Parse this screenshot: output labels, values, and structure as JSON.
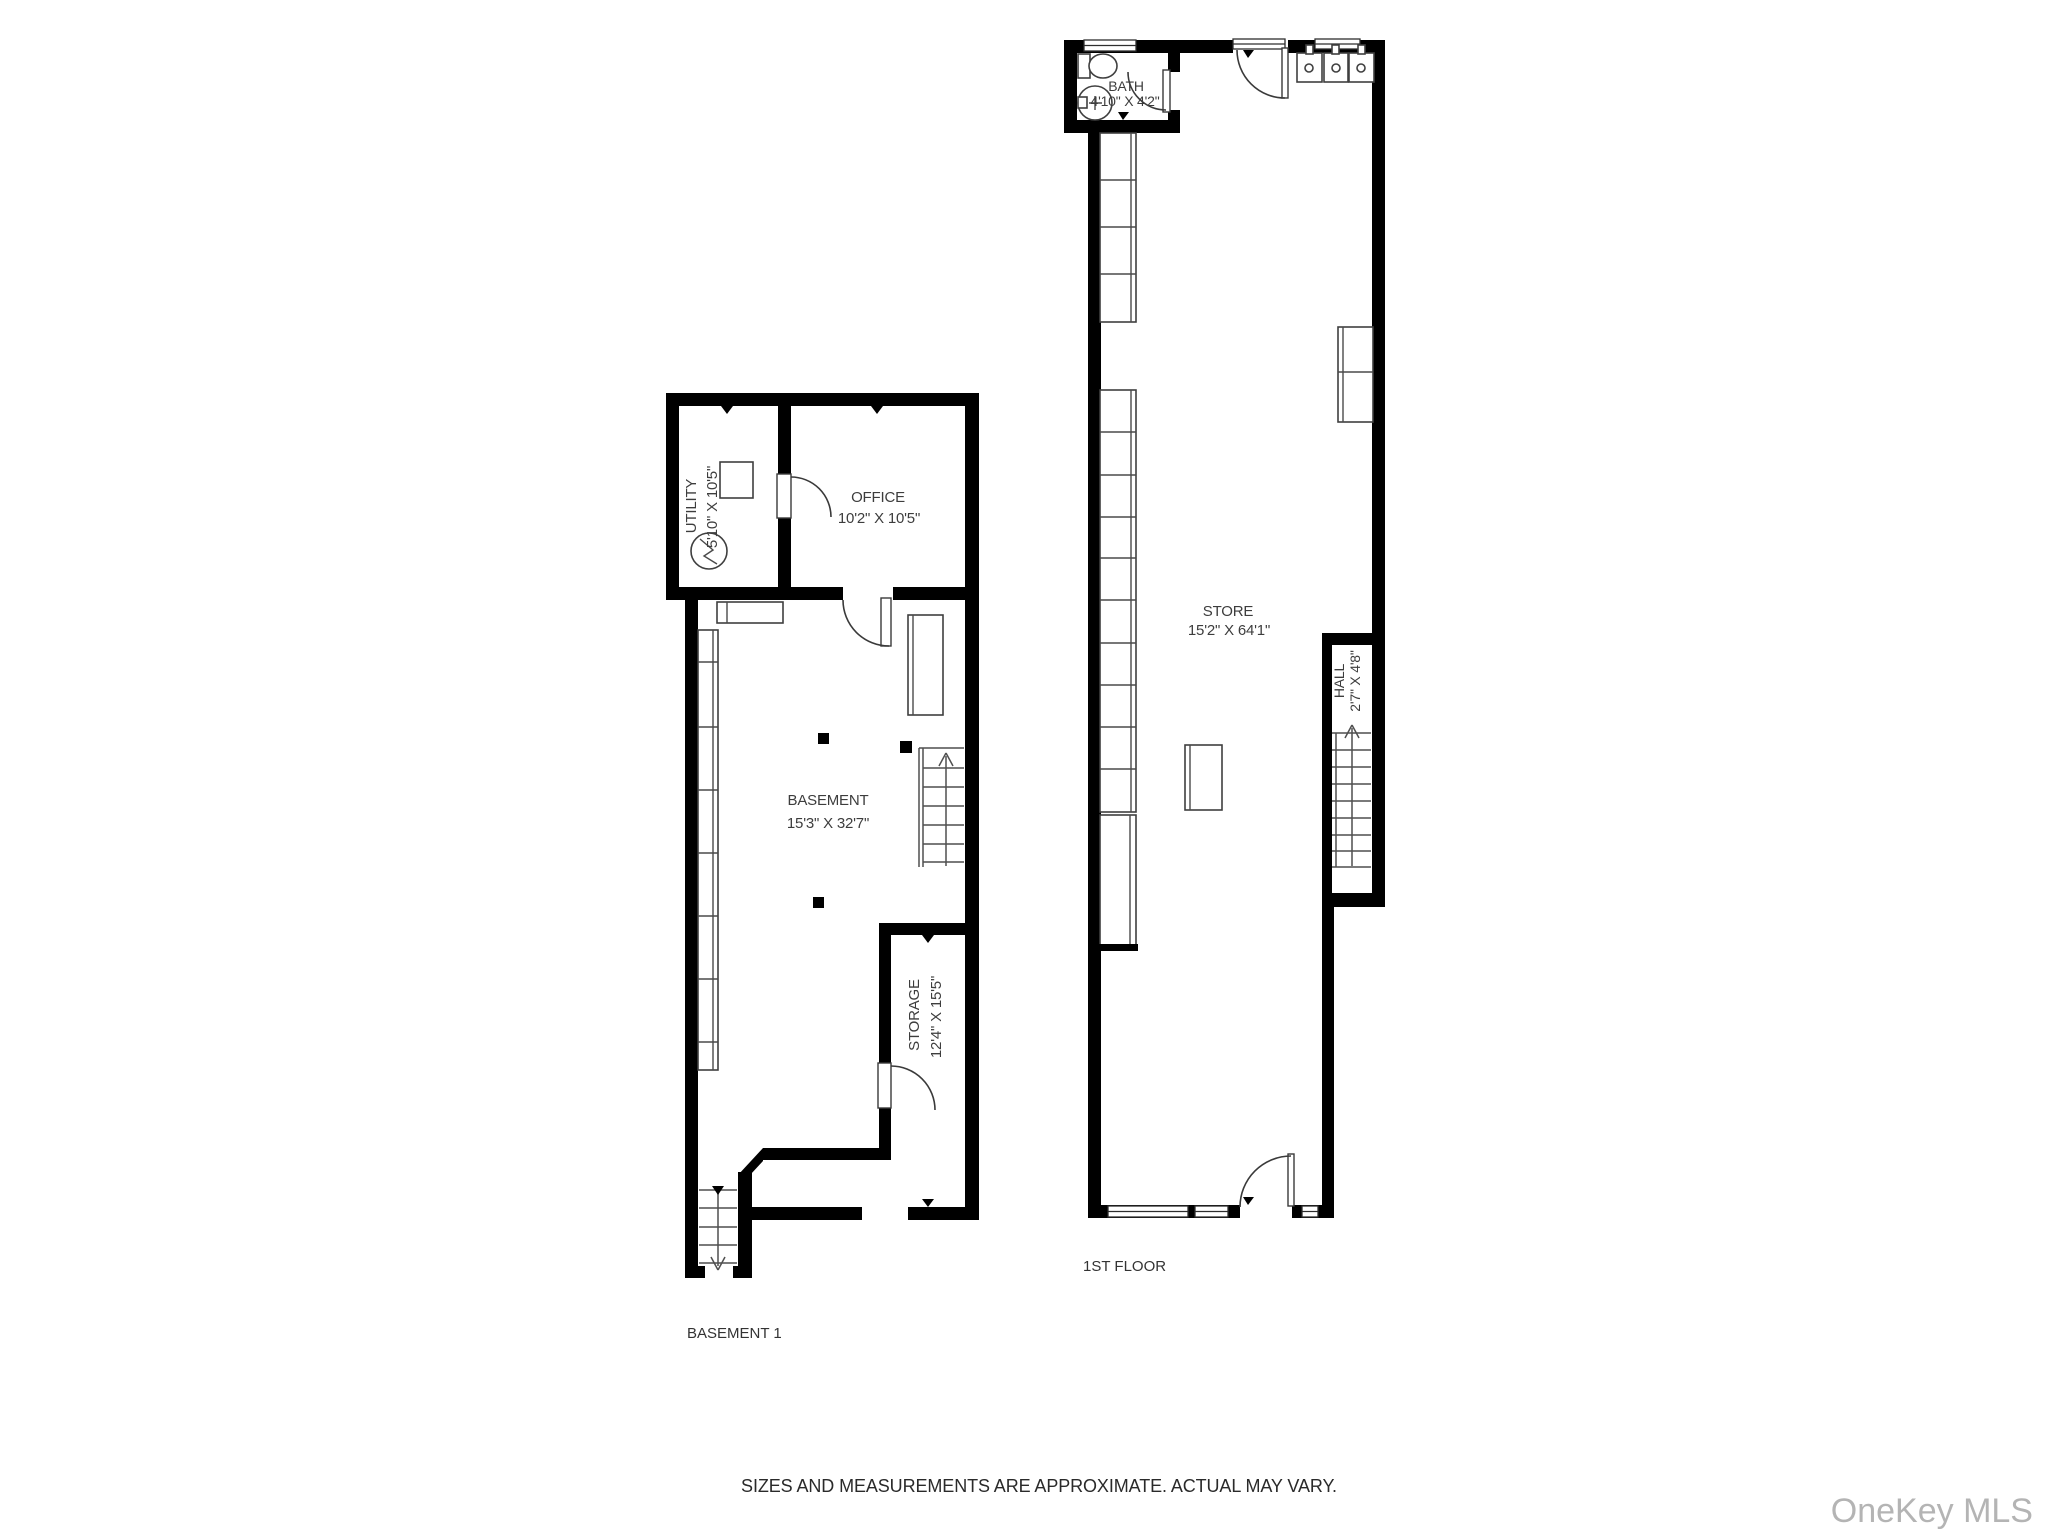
{
  "footer": {
    "note": "SIZES AND MEASUREMENTS ARE APPROXIMATE. ACTUAL MAY VARY."
  },
  "watermark": {
    "text": "OneKey MLS"
  },
  "colors": {
    "wall": "#000000",
    "line": "#3f3f3f",
    "label": "#3d3d3d",
    "watermark": "#b4b4b4",
    "background": "#ffffff"
  },
  "basement": {
    "caption": "BASEMENT 1",
    "rooms": {
      "utility": {
        "name": "UTILITY",
        "dims": "5'10\" X 10'5\""
      },
      "office": {
        "name": "OFFICE",
        "dims": "10'2\" X 10'5\""
      },
      "main": {
        "name": "BASEMENT",
        "dims": "15'3\" X 32'7\""
      },
      "storage": {
        "name": "STORAGE",
        "dims": "12'4\" X 15'5\""
      }
    },
    "fixtures": [
      "electrical-panel-icon",
      "utility-unit",
      "counter",
      "wall-shelving",
      "support-posts",
      "staircase-up",
      "staircase-down",
      "table",
      "door-swings"
    ]
  },
  "first_floor": {
    "caption": "1ST FLOOR",
    "rooms": {
      "bath": {
        "name": "BATH",
        "dims": "4'10\" X 4'2\""
      },
      "store": {
        "name": "STORE",
        "dims": "15'2\" X 64'1\""
      },
      "hall": {
        "name": "HALL",
        "dims": "2'7\" X 4'8\""
      }
    },
    "fixtures": [
      "toilet-icon",
      "round-sink-icon",
      "triple-sink-unit",
      "wall-shelving",
      "counter",
      "display-table",
      "wall-cabinet",
      "staircase-up",
      "storefront-windows",
      "entry-doors"
    ]
  }
}
